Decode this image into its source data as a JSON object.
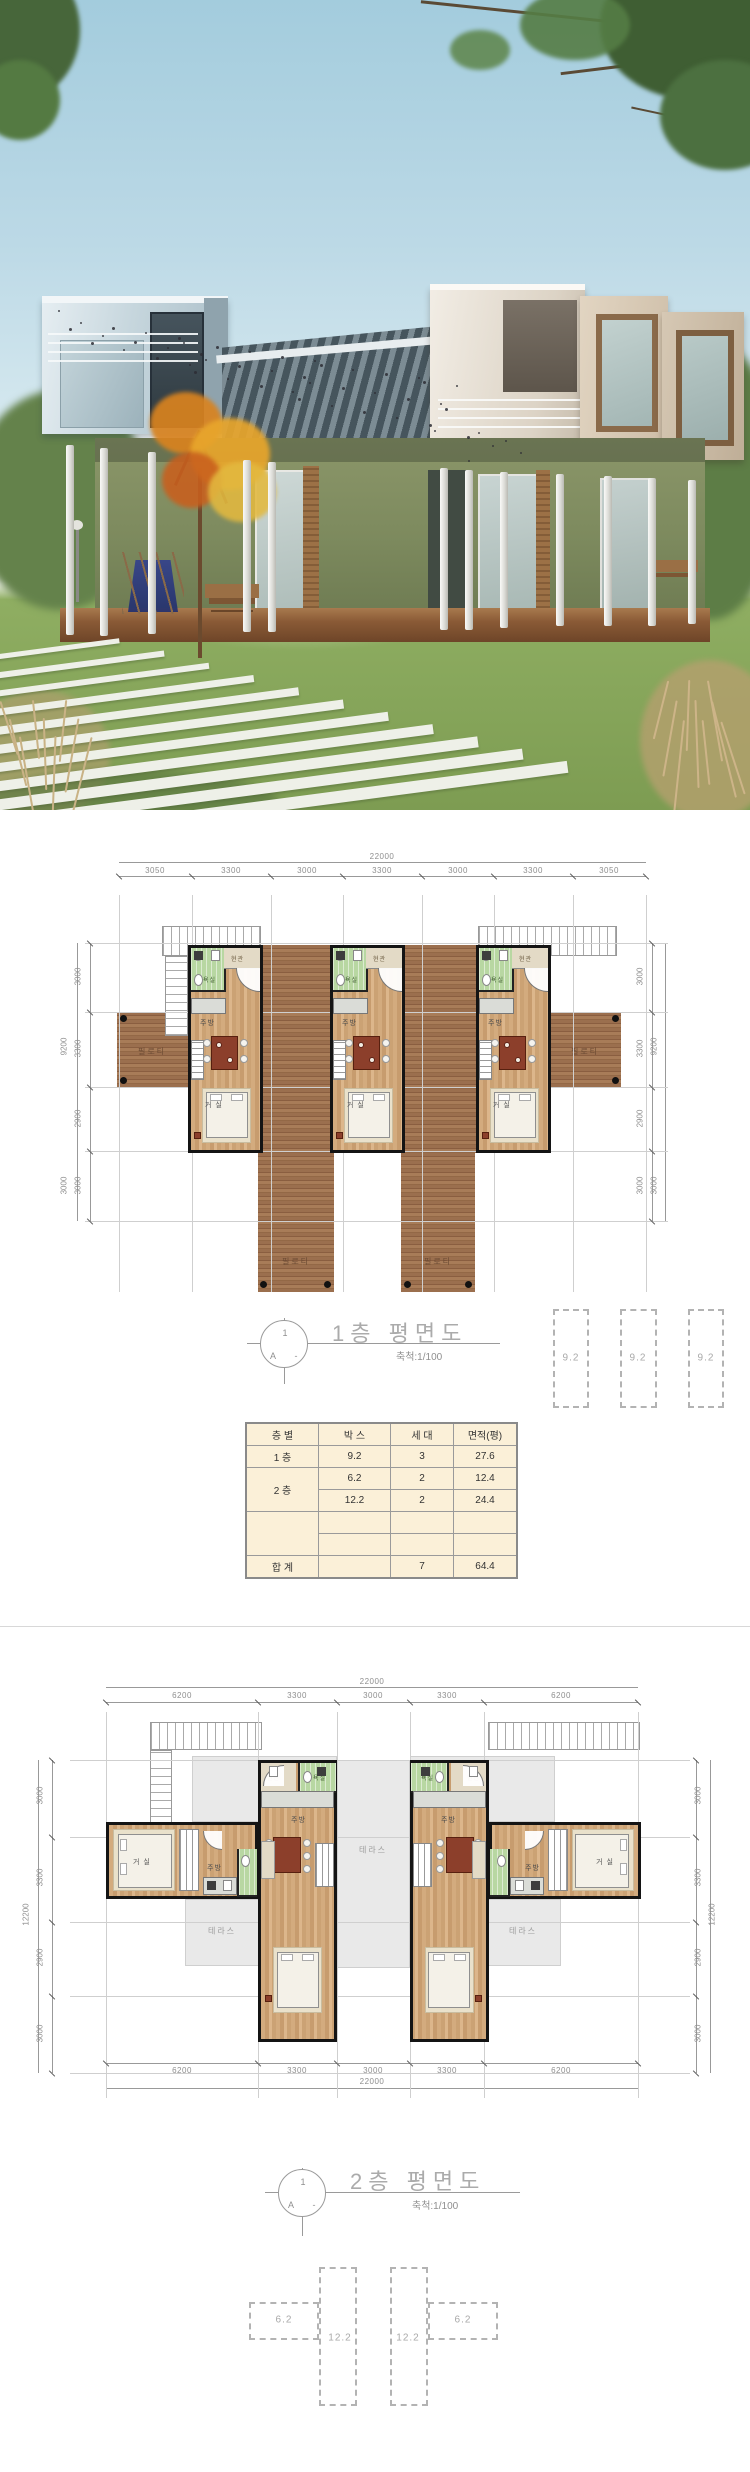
{
  "palette": {
    "sky": "#a3ccdd",
    "lawn": "#7d9c52",
    "wood_floor": "#cfa678",
    "deck_wood": "#9a6e4c",
    "bath_tile": "#b8d7a2",
    "table_bg": "#fbf0d8",
    "wall": "#141414",
    "dim_text": "#8e8e8e",
    "title_text": "#ababab",
    "terrace": "#e9e9e9",
    "accent_red": "#8c3f2b"
  },
  "plan1": {
    "total_width": "22000",
    "dims_top": [
      "3050",
      "3300",
      "3000",
      "3300",
      "3000",
      "3300",
      "3050"
    ],
    "dims_side": [
      "3000",
      "3300",
      "2900",
      "3000"
    ],
    "side_total": "9200",
    "side_lower": "3000",
    "rooms": {
      "bath": "욕실",
      "entry": "현관",
      "kitchen": "주방",
      "living": "거 실",
      "piloti": "필로티"
    },
    "title": {
      "num": "1",
      "letter": "A",
      "dash": "-",
      "text": "1층 평면도",
      "scale": "축척:1/100"
    },
    "area_boxes": [
      "9.2",
      "9.2",
      "9.2"
    ]
  },
  "summary_table": {
    "headers": [
      "층 별",
      "박 스",
      "세 대",
      "면적(평)"
    ],
    "col_floor": [
      "1 층",
      "2 층",
      "합  계"
    ],
    "rows": [
      {
        "box": "9.2",
        "units": "3",
        "area": "27.6"
      },
      {
        "box": "6.2",
        "units": "2",
        "area": "12.4"
      },
      {
        "box": "12.2",
        "units": "2",
        "area": "24.4"
      },
      {
        "box": "",
        "units": "",
        "area": ""
      },
      {
        "box": "",
        "units": "",
        "area": ""
      },
      {
        "box": "",
        "units": "7",
        "area": "64.4"
      }
    ]
  },
  "plan2": {
    "total_width": "22000",
    "dims_top": [
      "6200",
      "3300",
      "3000",
      "3300",
      "6200"
    ],
    "dims_bottom": [
      "6200",
      "3300",
      "3000",
      "3300",
      "6200"
    ],
    "bottom_total": "22000",
    "dims_side": [
      "3000",
      "3300",
      "2900",
      "3000"
    ],
    "side_total": "12200",
    "rooms": {
      "bath": "욕실",
      "entry": "현관",
      "kitchen": "주방",
      "living": "거 실",
      "terrace": "테라스"
    },
    "title": {
      "num": "1",
      "letter": "A",
      "dash": "-",
      "text": "2층 평면도",
      "scale": "축척:1/100"
    },
    "diagram": {
      "box_small": "6.2",
      "box_tall": "12.2"
    }
  }
}
